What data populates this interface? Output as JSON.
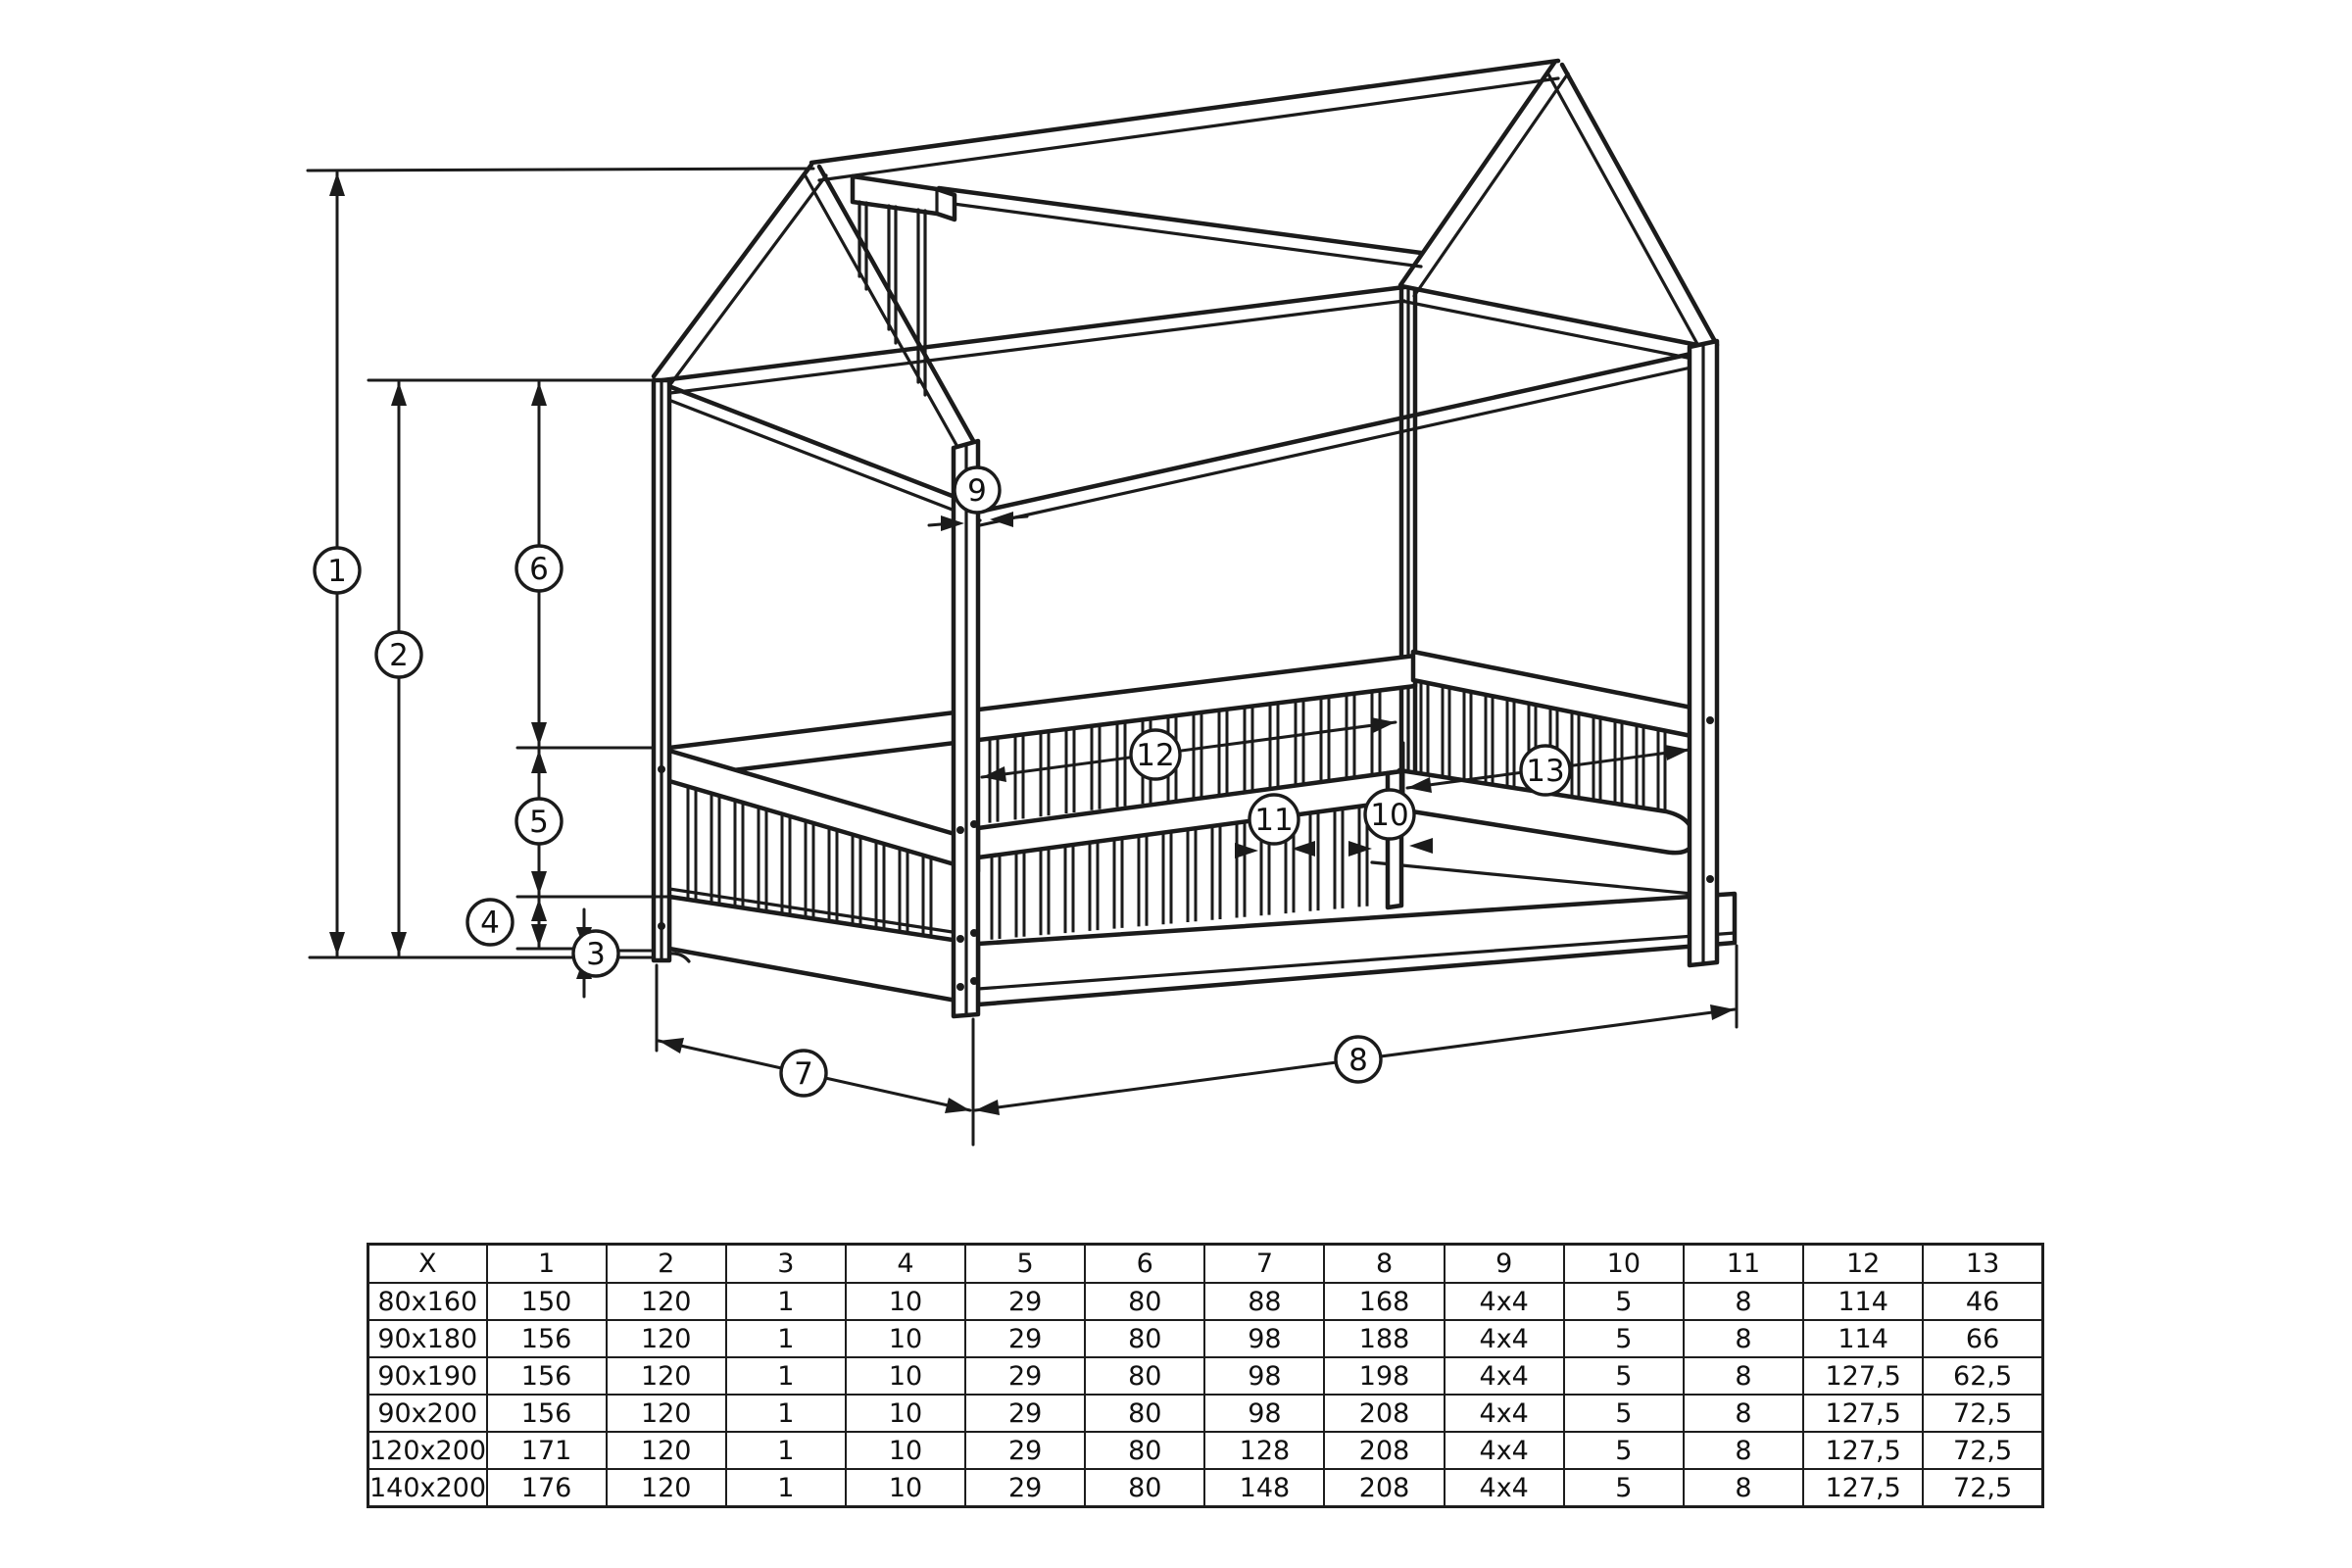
{
  "diagram": {
    "title": "house bed frame assembly dimensions",
    "callouts": {
      "c1": "1",
      "c2": "2",
      "c3": "3",
      "c4": "4",
      "c5": "5",
      "c6": "6",
      "c7": "7",
      "c8": "8",
      "c9": "9",
      "c10": "10",
      "c11": "11",
      "c12": "12",
      "c13": "13"
    }
  },
  "table": {
    "headers": [
      "X",
      "1",
      "2",
      "3",
      "4",
      "5",
      "6",
      "7",
      "8",
      "9",
      "10",
      "11",
      "12",
      "13"
    ],
    "rows": [
      [
        "80x160",
        "150",
        "120",
        "1",
        "10",
        "29",
        "80",
        "88",
        "168",
        "4x4",
        "5",
        "8",
        "114",
        "46"
      ],
      [
        "90x180",
        "156",
        "120",
        "1",
        "10",
        "29",
        "80",
        "98",
        "188",
        "4x4",
        "5",
        "8",
        "114",
        "66"
      ],
      [
        "90x190",
        "156",
        "120",
        "1",
        "10",
        "29",
        "80",
        "98",
        "198",
        "4x4",
        "5",
        "8",
        "127,5",
        "62,5"
      ],
      [
        "90x200",
        "156",
        "120",
        "1",
        "10",
        "29",
        "80",
        "98",
        "208",
        "4x4",
        "5",
        "8",
        "127,5",
        "72,5"
      ],
      [
        "120x200",
        "171",
        "120",
        "1",
        "10",
        "29",
        "80",
        "128",
        "208",
        "4x4",
        "5",
        "8",
        "127,5",
        "72,5"
      ],
      [
        "140x200",
        "176",
        "120",
        "1",
        "10",
        "29",
        "80",
        "148",
        "208",
        "4x4",
        "5",
        "8",
        "127,5",
        "72,5"
      ]
    ]
  },
  "colors": {
    "line": "#1b1b1b",
    "background": "#ffffff"
  }
}
